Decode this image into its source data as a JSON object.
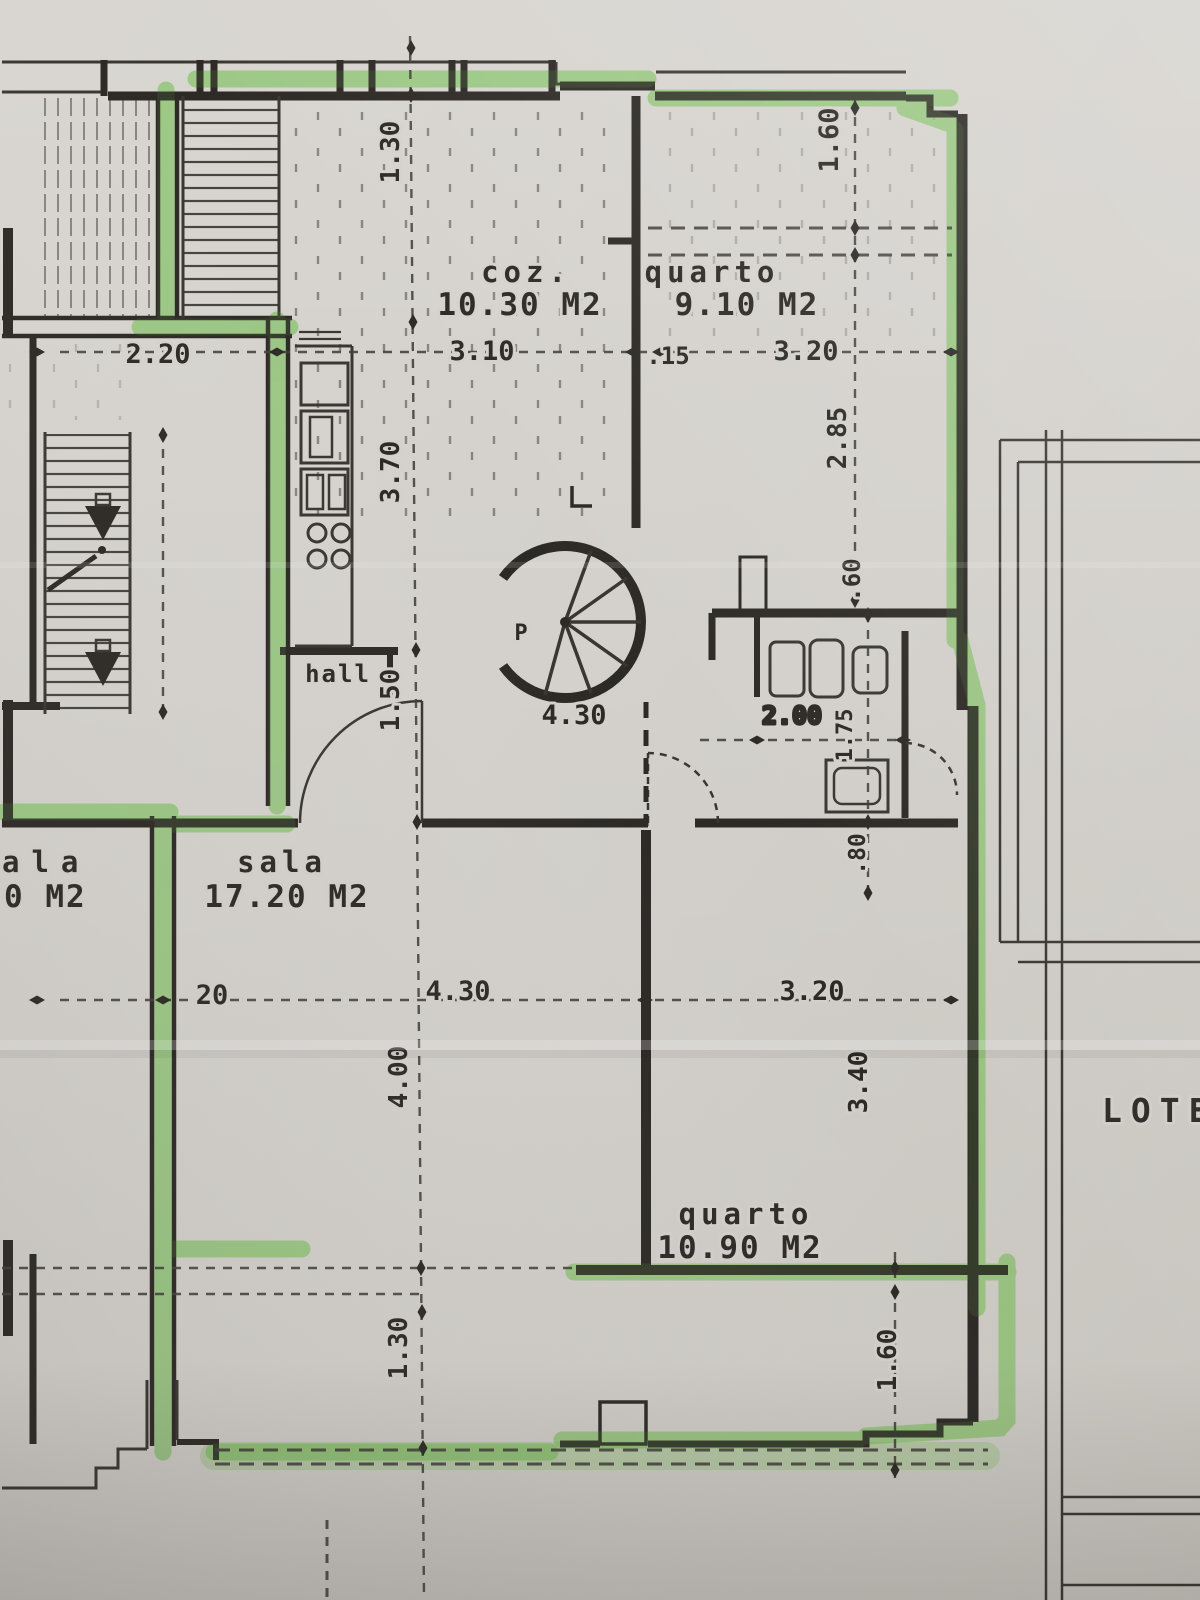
{
  "plan": {
    "rooms": {
      "kitchen": {
        "label": "coz.",
        "area": "10.30 M2"
      },
      "bedroom_top": {
        "label": "quarto",
        "area": "9.10 M2"
      },
      "living": {
        "label": "sala",
        "area": "17.20 M2"
      },
      "bedroom_bottom": {
        "label": "quarto",
        "area": "10.90 M2"
      },
      "hall": {
        "label": "hall"
      },
      "neighbor_partial": {
        "label": "ala",
        "area": "0 M2"
      }
    },
    "stair": {
      "label": "P"
    },
    "site": {
      "lot": "LOTE"
    },
    "dimensions": {
      "d_2_20": "2.20",
      "d_1_30_top": "1.30",
      "d_1_60_top": "1.60",
      "d_3_10": "3.10",
      "d_0_15": ".15",
      "d_3_20_top": "3.20",
      "d_3_70": "3.70",
      "d_2_85": "2.85",
      "d_0_60": ".60",
      "d_1_50": "1.50",
      "d_4_30_hall": "4.30",
      "d_2_00": "2.00",
      "d_1_75": "1.75",
      "d_0_80": ".80",
      "d_20": "20",
      "d_4_30_sala": "4.30",
      "d_4_00": "4.00",
      "d_3_20_bottom": "3.20",
      "d_3_40": "3.40",
      "d_1_30_bottom": "1.30",
      "d_1_60_bottom": "1.60"
    },
    "colors": {
      "highlighter_green": "#79c158",
      "ink": "#2d2a26",
      "paper": "#d6d3ce"
    }
  }
}
